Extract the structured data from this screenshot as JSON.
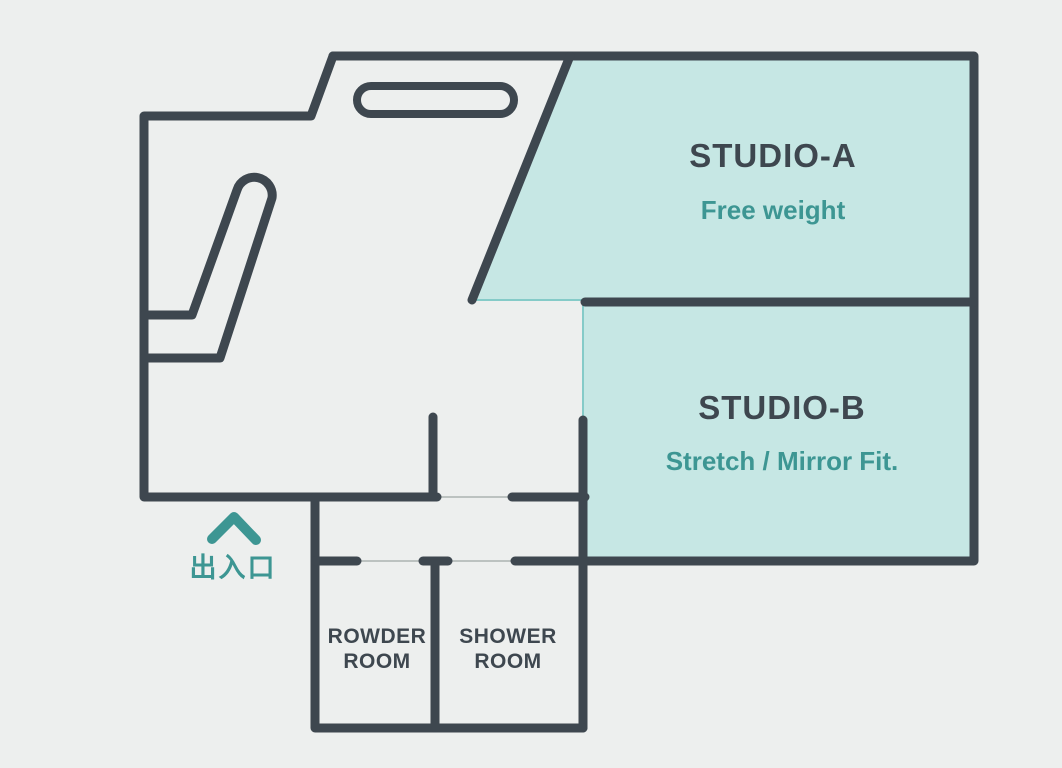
{
  "areas": {
    "studio_a": {
      "name": "STUDIO-A",
      "description": "Free weight"
    },
    "studio_b": {
      "name": "STUDIO-B",
      "description": "Stretch / Mirror Fit."
    },
    "rowder_room": {
      "name_line1": "ROWDER",
      "name_line2": "ROOM"
    },
    "shower_room": {
      "name_line1": "SHOWER",
      "name_line2": "ROOM"
    },
    "entrance": {
      "label": "出入口",
      "icon": "chevron-up-icon"
    }
  },
  "colors": {
    "background": "#edefee",
    "wall": "#3e474f",
    "studio_fill": "#c6e7e4",
    "studio_edge": "#85cbc8",
    "accent_teal": "#3d9693",
    "dark_text": "#3e474f",
    "door_line": "#bcc2c0"
  }
}
